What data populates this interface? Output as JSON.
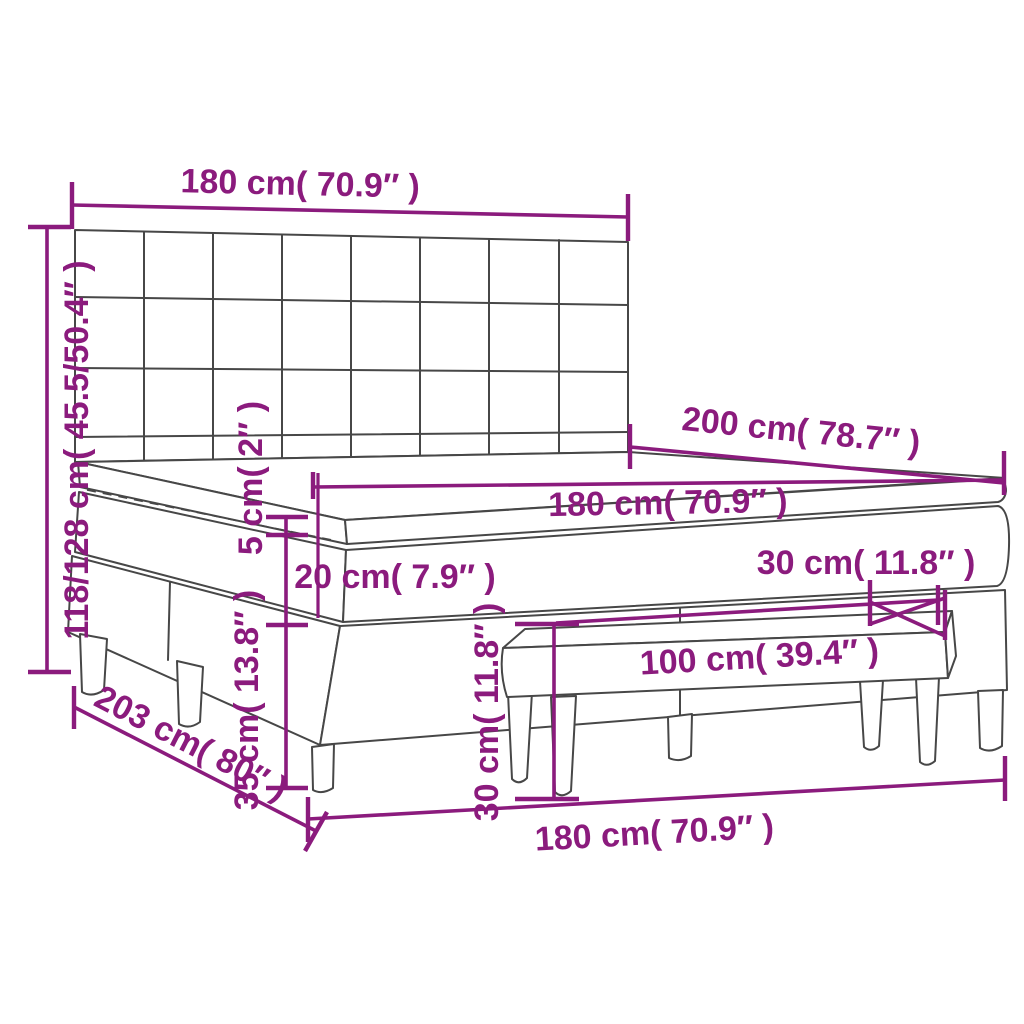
{
  "diagram": {
    "kind": "furniture-dimension-diagram",
    "subject": "box-spring-bed-with-headboard-mattress-topper-and-bench"
  },
  "colors": {
    "dimension": "#8b1b7d",
    "outline": "#474747",
    "surface": "#ffffff"
  },
  "dimensions": {
    "headboard_width": "180 cm( 70.9″ )",
    "total_height": "118/128 cm( 45.5/50.4″ )",
    "bed_length": "200 cm( 78.7″ )",
    "mattress_width": "180 cm( 70.9″ )",
    "topper_thickness": "5 cm( 2″ )",
    "mattress_thickness": "20 cm( 7.9″ )",
    "base_height": "35 cm( 13.8″ )",
    "bench_depth": "30 cm( 11.8″ )",
    "bench_height": "30 cm( 11.8″ )",
    "bench_length": "100 cm( 39.4″ )",
    "floor_length": "203 cm( 80″ )",
    "floor_width": "180 cm( 70.9″ )"
  }
}
